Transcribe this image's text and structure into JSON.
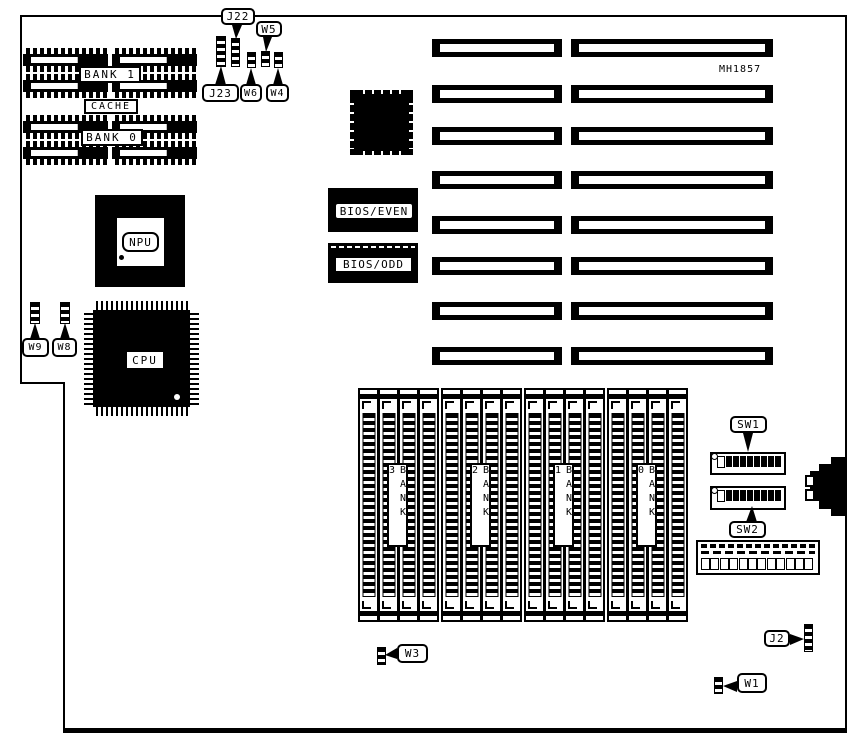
{
  "board": {
    "id": "MH1857"
  },
  "cache_area": {
    "bank1_label": "BANK 1",
    "cache_label": "CACHE",
    "bank0_label": "BANK 0"
  },
  "chips": {
    "npu_label": "NPU",
    "cpu_label": "CPU",
    "bios_even_label": "BIOS/EVEN",
    "bios_odd_label": "BIOS/ODD"
  },
  "jumpers": {
    "j22": "J22",
    "w5": "W5",
    "j23": "J23",
    "w6": "W6",
    "w4": "W4",
    "w9": "W9",
    "w8": "W8",
    "w3": "W3",
    "w1": "W1",
    "j2": "J2"
  },
  "switches": {
    "sw1_label": "SW1",
    "sw2_label": "SW2",
    "dip_positions": 8
  },
  "memory": {
    "banks": [
      {
        "label": "BANK 3"
      },
      {
        "label": "BANK 2"
      },
      {
        "label": "BANK 1"
      },
      {
        "label": "BANK 0"
      }
    ],
    "sockets_per_bank": 4
  },
  "expansion": {
    "slot_rows": 8
  },
  "io": {
    "edge_connector_pins": 12
  }
}
